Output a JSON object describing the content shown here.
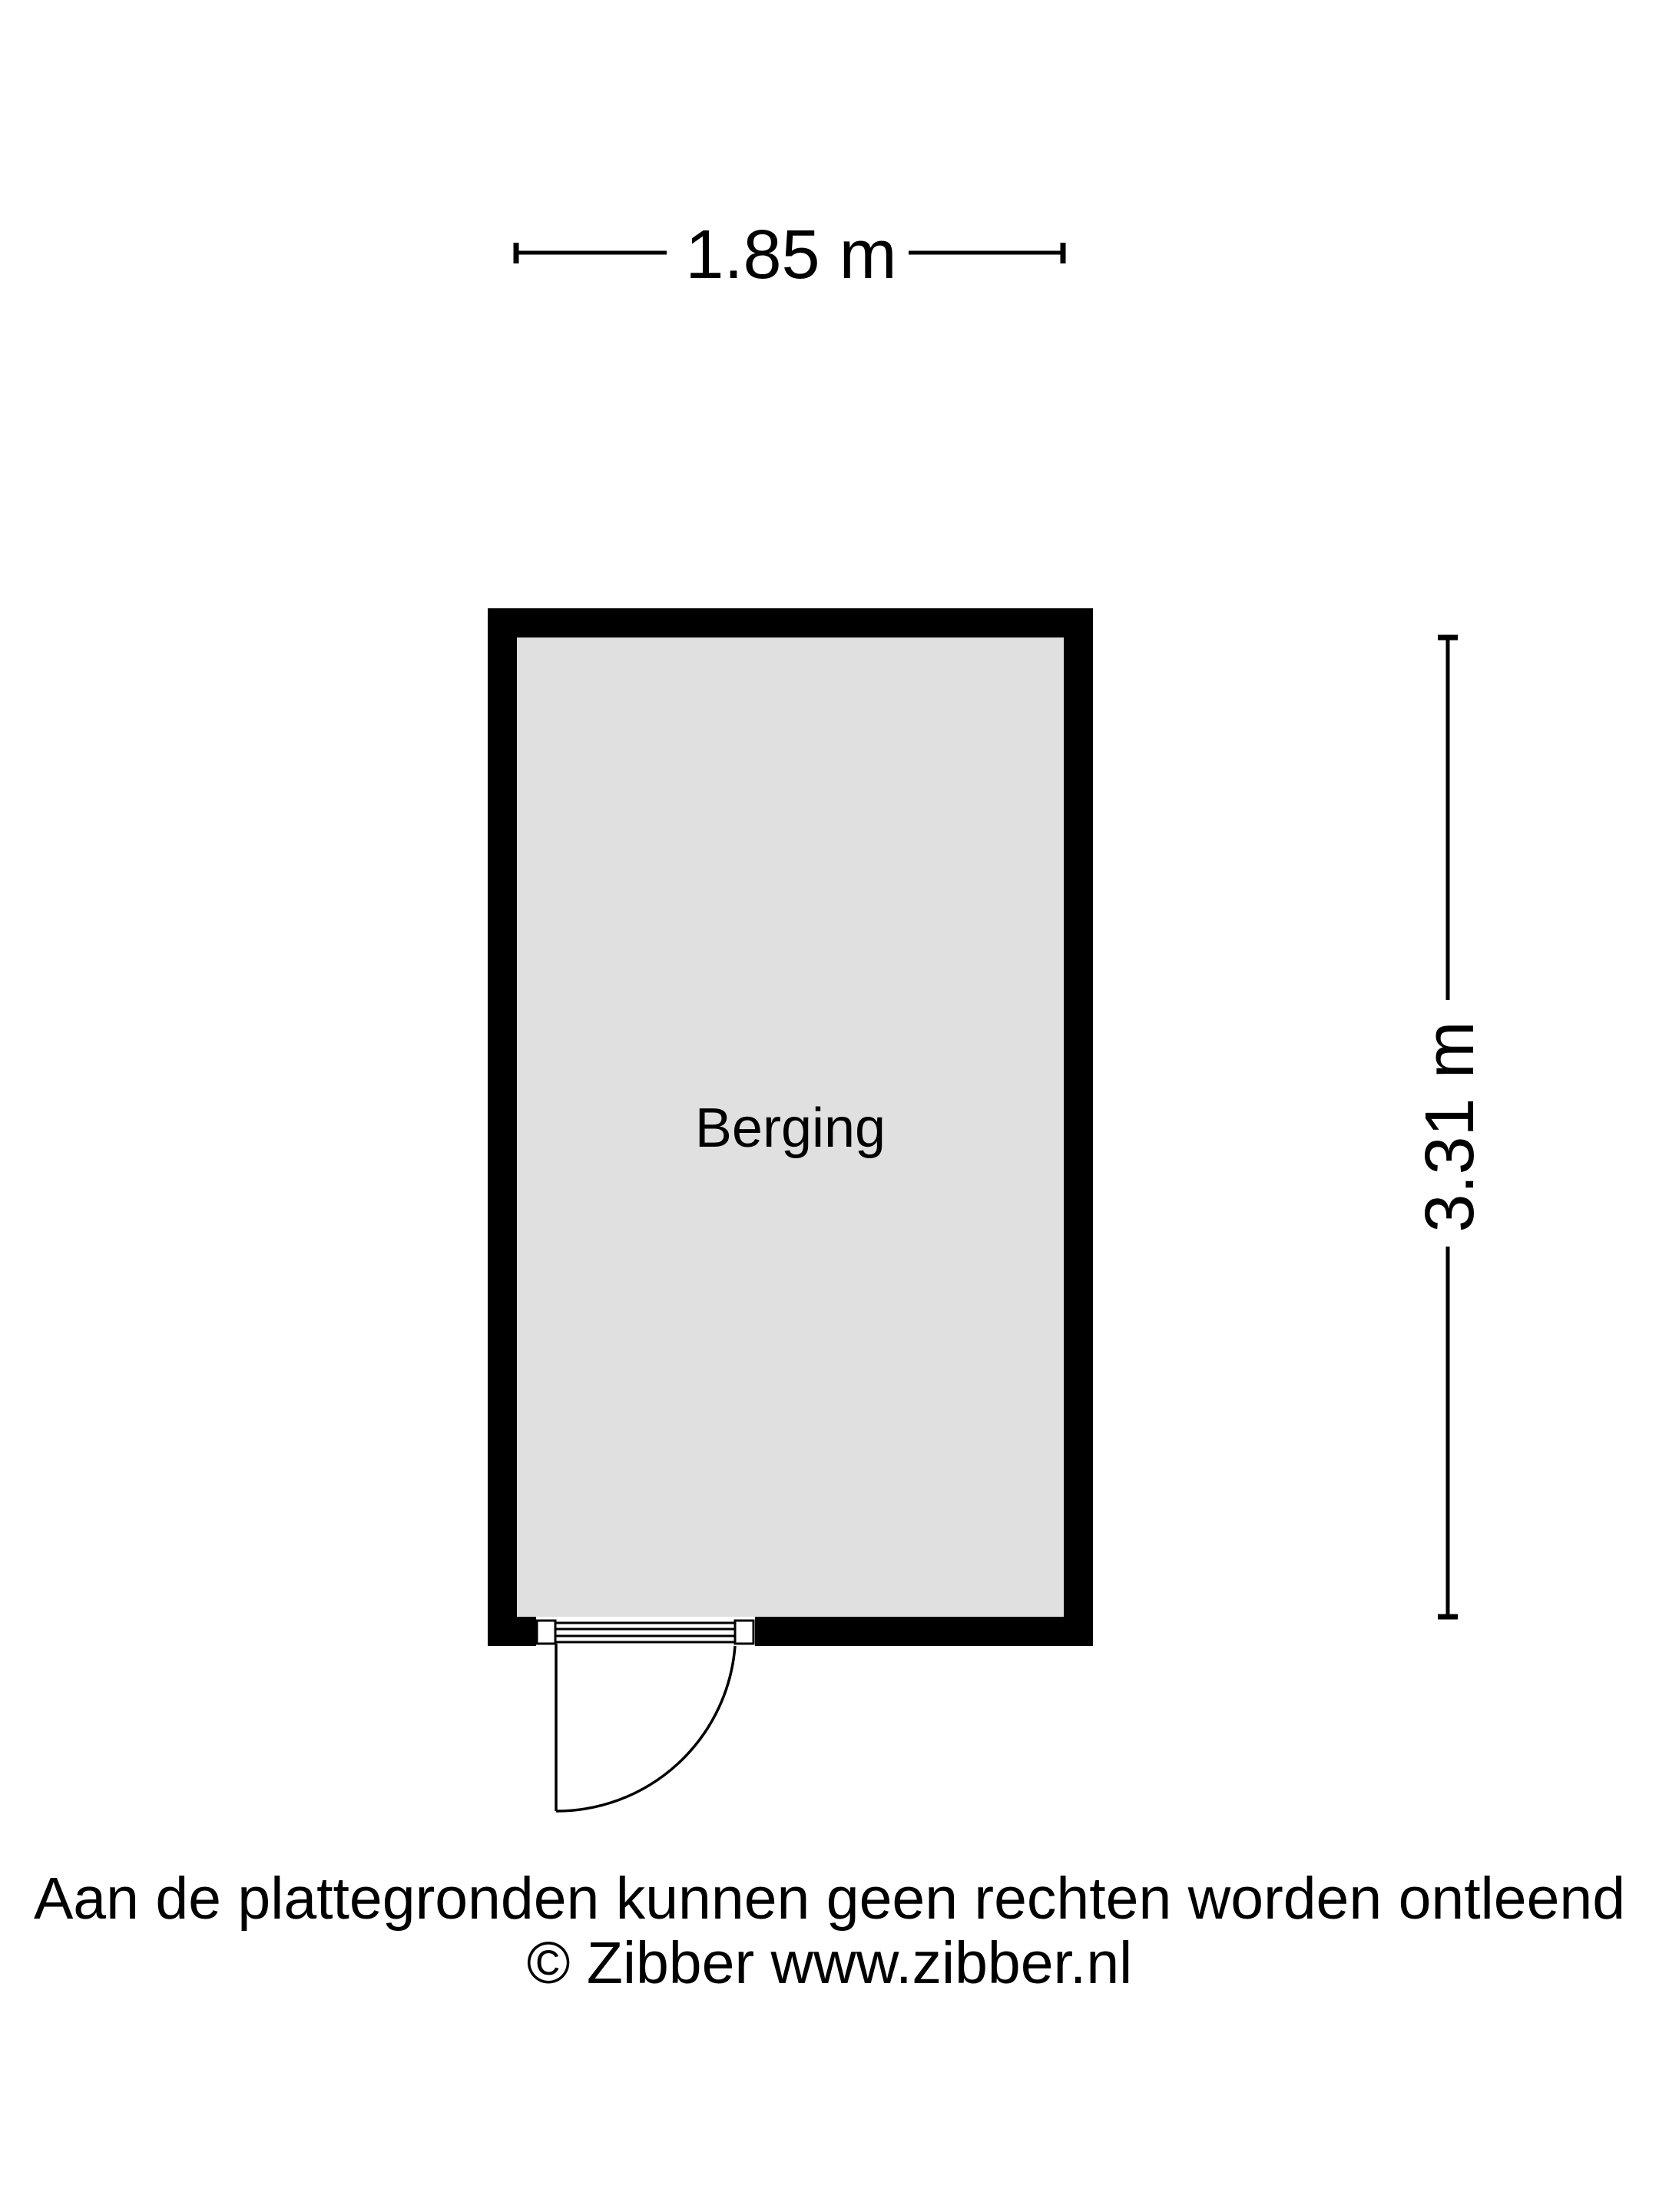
{
  "page": {
    "background": "#ffffff"
  },
  "floor_plan": {
    "room_label": "Berging",
    "width_dimension": "1.85 m",
    "height_dimension": "3.31 m",
    "colors": {
      "wall": "#000000",
      "floor": "#e0e0e0",
      "line": "#000000",
      "opening": "#ffffff"
    }
  },
  "footer": {
    "disclaimer": "Aan de plattegronden kunnen geen rechten worden ontleend",
    "copyright": "© Zibber www.zibber.nl"
  }
}
